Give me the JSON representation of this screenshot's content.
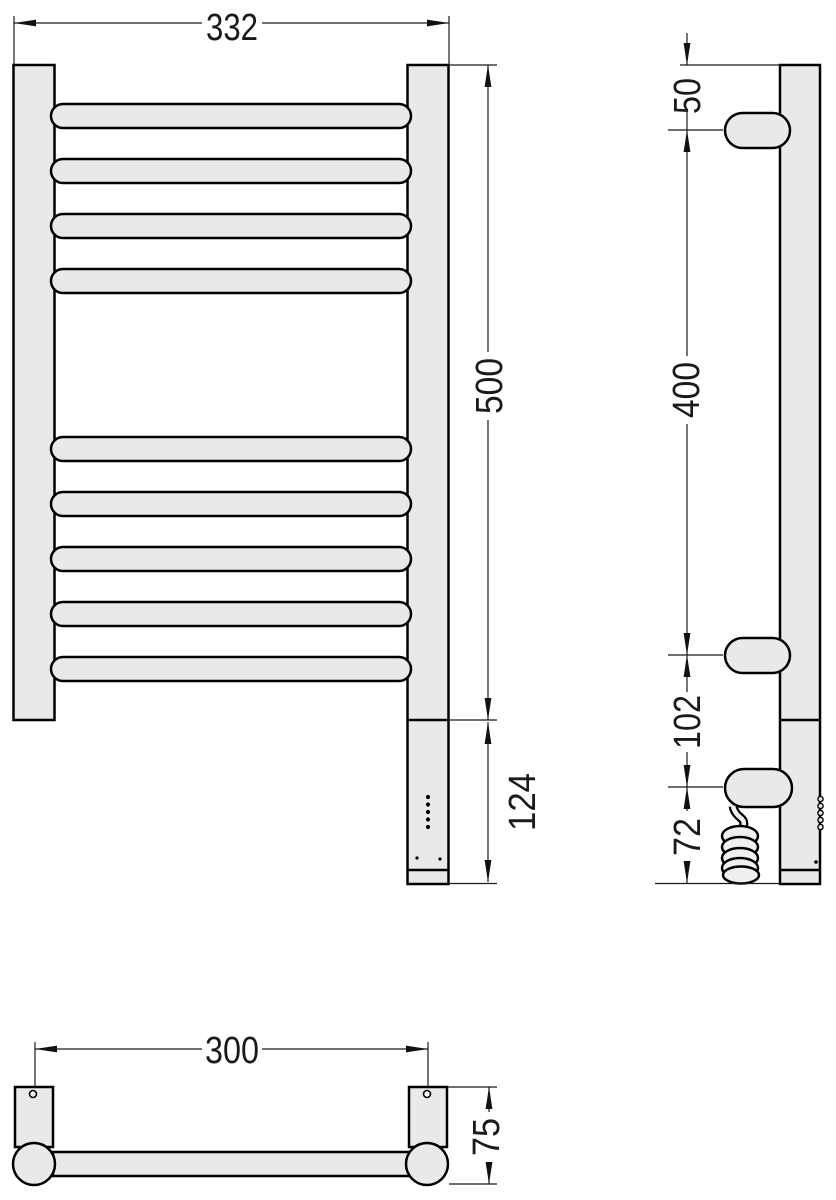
{
  "drawing": {
    "type": "technical-dimension-drawing",
    "subject": "electric heated towel rail",
    "views": {
      "front": {
        "overall_width_mm": "332",
        "overall_height_mm": "500",
        "heating_element_length_mm": "124"
      },
      "side": {
        "top_to_upper_bracket_mm": "50",
        "bracket_spacing_mm": "400",
        "lower_bracket_to_connection_mm": "102",
        "connection_to_bottom_mm": "72"
      },
      "bottom": {
        "mounting_centres_mm": "300",
        "depth_mm": "75"
      }
    },
    "colors": {
      "body_fill": "#e9e9e9",
      "outline": "#000000",
      "dimension_lines": "#1a1a1a",
      "background": "#ffffff"
    }
  }
}
